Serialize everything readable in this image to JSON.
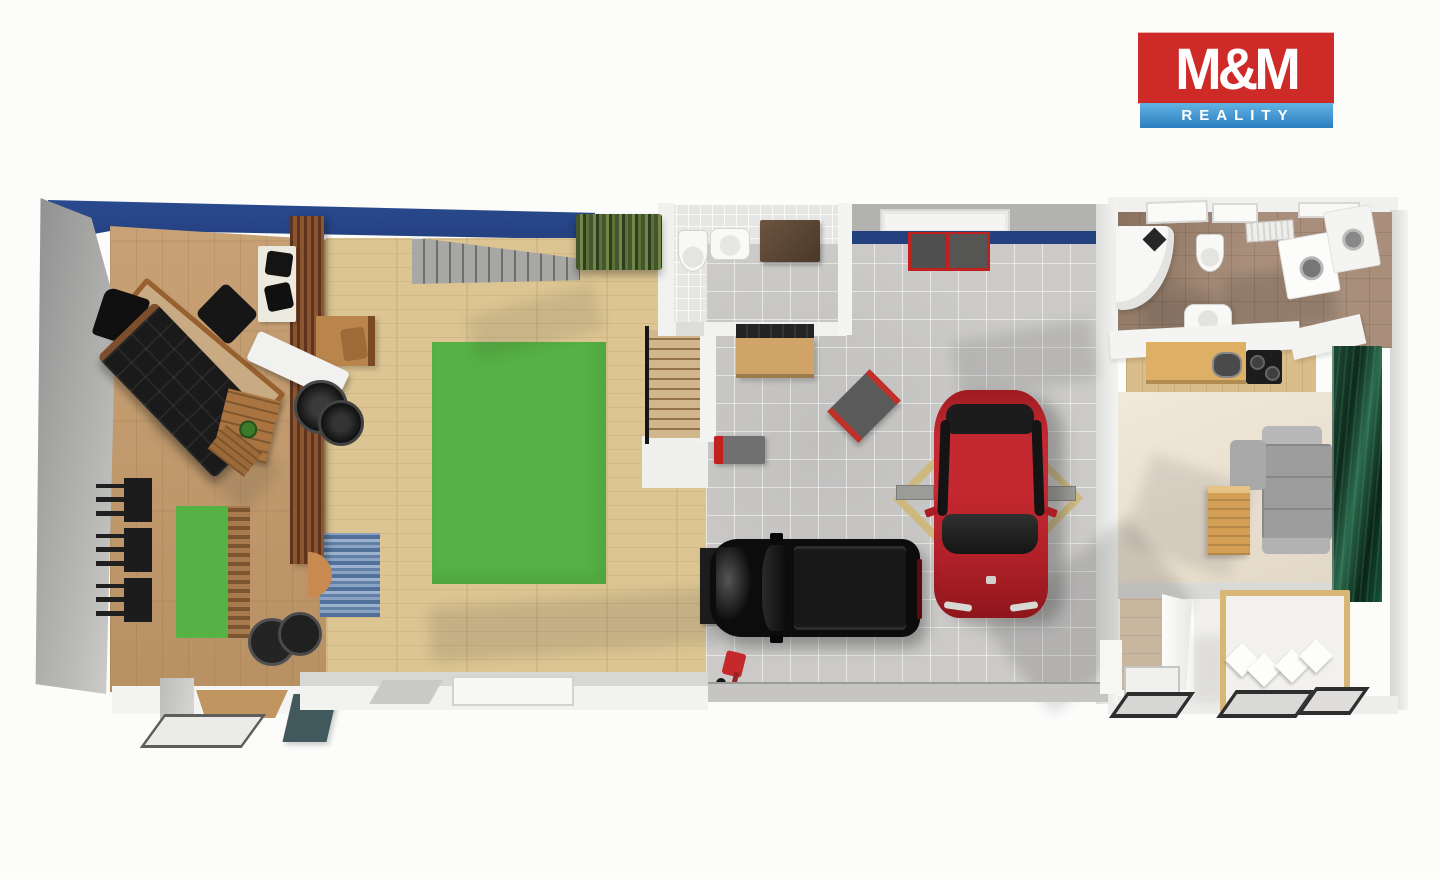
{
  "logo": {
    "title": "M&M",
    "subtitle": "REALITY"
  },
  "palette": {
    "wall_navy": "#23407f",
    "wall_gray": "#9a9a9a",
    "floor_office": "#c39a6a",
    "floor_hall": "#dcc592",
    "floor_garage": "#cbcac8",
    "floor_wc": "#e6e6e4",
    "floor_bath": "#a98f7b",
    "floor_living": "#ece1cf",
    "rug_green": "#56b244",
    "rug_blue": "#6e8fb3",
    "car_red": "#c42830",
    "car_black": "#0c0c0c",
    "sofa_black": "#1a1a1a",
    "sofa_gray": "#9d9d9d",
    "accent_red": "#c1201e",
    "art_green": "#14392a",
    "bed_wood": "#d8b675",
    "stairs_gray": "#8d8d8b",
    "logo_red": "#ce2a28",
    "logo_blue": "#2e86c6"
  },
  "scene": {
    "type": "3d-floor-plan-top-view",
    "rooms": [
      {
        "name": "office-gym",
        "floor": "wood",
        "items": [
          "desk",
          "office-chair",
          "guest-chair",
          "black-leather-sofa",
          "coffee-table-with-plant",
          "white-side-table-with-chairs",
          "slatted-wood-partition",
          "weight-bench",
          "weight-plates",
          "wall-racks",
          "green-exercise-mat",
          "slat-rack",
          "black-ottomans"
        ]
      },
      {
        "name": "hall",
        "floor": "light-wood",
        "items": [
          "staircase-up",
          "potted-plants",
          "green-rug",
          "blue-runner-rug",
          "half-round-console",
          "side-table-with-seat",
          "stairwell-down-with-railing",
          "dark-shelf"
        ]
      },
      {
        "name": "wc",
        "floor": "white-tile",
        "items": [
          "toilet",
          "wall-sink",
          "dark-cabinet"
        ]
      },
      {
        "name": "garage",
        "floor": "gray-tile",
        "items": [
          "tool-wall",
          "workbench",
          "red-cabinets",
          "red-tool-box",
          "tilted-tool-cart",
          "car-lift-arms",
          "red-car",
          "black-suv",
          "trolley-jack",
          "garage-door"
        ]
      },
      {
        "name": "bathroom",
        "floor": "brown-tile",
        "items": [
          "corner-bathtub",
          "shower-head",
          "wall-toilet",
          "sink",
          "washer-dryer-stack",
          "skylights",
          "vent-grille"
        ]
      },
      {
        "name": "kitchen",
        "floor": "wood",
        "items": [
          "white-counter",
          "wood-counter",
          "kitchen-sink",
          "cooktop",
          "white-cabinets"
        ]
      },
      {
        "name": "living-bedroom",
        "floor": "cream",
        "items": [
          "gray-corner-sofa",
          "wood-side-table",
          "green-wall-art",
          "double-bed-with-pillows",
          "shower-corner",
          "doormats"
        ]
      }
    ],
    "exterior_items": [
      "entrance-doormat",
      "teal-door-panel",
      "steps"
    ]
  }
}
